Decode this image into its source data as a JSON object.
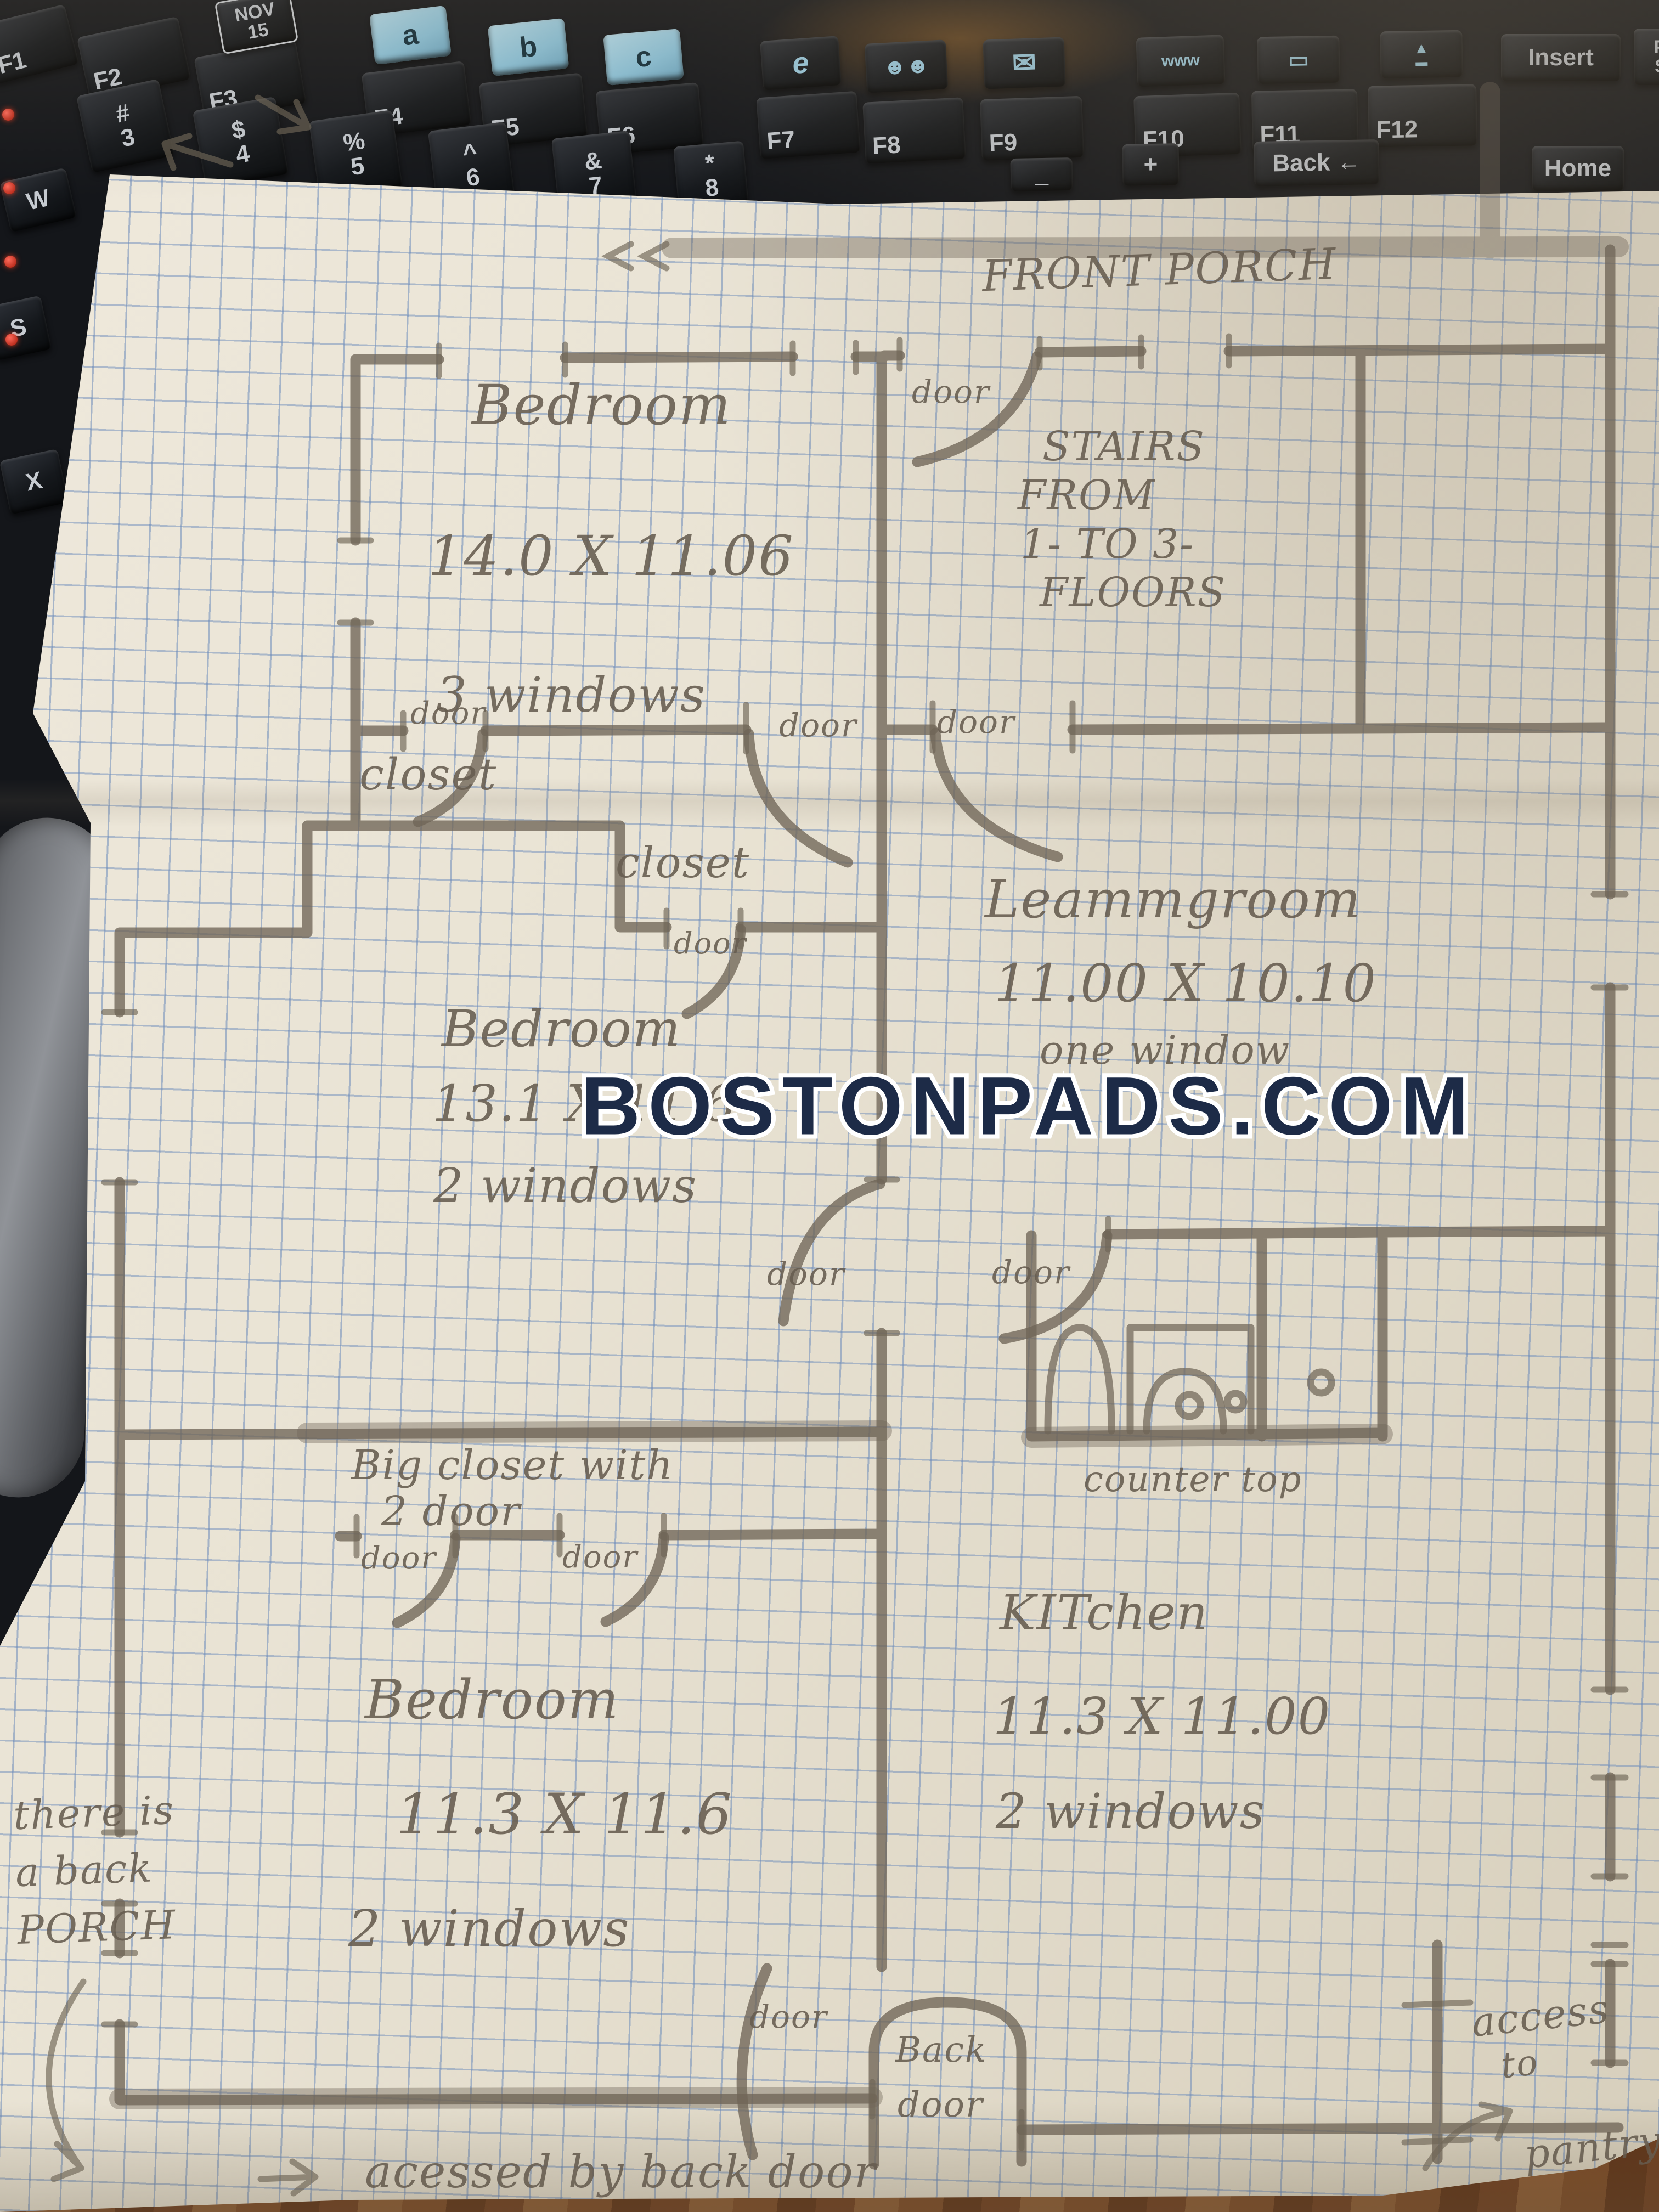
{
  "watermark": {
    "text": "BOSTONPADS.COM",
    "color": "#1d2b47"
  },
  "plan": {
    "door_label": "door",
    "front_porch": "FRONT PORCH",
    "stairs": {
      "l1": "STAIRS",
      "l2": "FROM",
      "l3": "1- TO 3-",
      "l4": "FLOORS"
    },
    "bedroom_top": {
      "name": "Bedroom",
      "dims": "14.0 X 11.06",
      "windows": "3 windows"
    },
    "closet_top": "closet",
    "closet_mid": "closet",
    "living": {
      "name": "Leammgroom",
      "dims": "11.00 X 10.10",
      "windows": "one window"
    },
    "bedroom_mid": {
      "name": "Bedroom",
      "dims": "13.1 X 11.6",
      "windows": "2 windows"
    },
    "bathroom": {
      "counter": "counter top"
    },
    "kitchen": {
      "name": "KITchen",
      "dims": "11.3 X 11.00",
      "windows": "2 windows"
    },
    "big_closet": {
      "l1": "Big closet with",
      "l2": "2 door"
    },
    "bedroom_bottom": {
      "name": "Bedroom",
      "dims": "11.3 X 11.6",
      "windows": "2 windows"
    },
    "back_door": {
      "l1": "Back",
      "l2": "door"
    },
    "notes": {
      "back_porch_l1": "there is",
      "back_porch_l2": "a back",
      "back_porch_l3": "PORCH",
      "accessed": "acessed by back door",
      "pantry_l1": "access",
      "pantry_l2": "to",
      "pantry_l3": "pantry"
    }
  },
  "keyboard": {
    "fkeys": [
      "F1",
      "F2",
      "F3",
      "F4",
      "F5",
      "F6",
      "F7",
      "F8",
      "F9",
      "F10",
      "F11",
      "F12"
    ],
    "hotkeys": [
      "a",
      "b",
      "c"
    ],
    "calendar": {
      "l1": "NOV",
      "l2": "15"
    },
    "icons": {
      "ie": "e",
      "people": "☻☻",
      "mail": "✉",
      "search": "www",
      "battery": "▭",
      "eject_top": "▲",
      "eject_bar": "▬",
      "back_arrow": "←",
      "down": "▼"
    },
    "numrow": [
      {
        "t": "#",
        "b": "3"
      },
      {
        "t": "$",
        "b": "4"
      },
      {
        "t": "%",
        "b": "5"
      },
      {
        "t": "^",
        "b": "6"
      },
      {
        "t": "&",
        "b": "7"
      },
      {
        "t": "*",
        "b": "8"
      }
    ],
    "letters": [
      "W",
      "S",
      "X"
    ],
    "insert": "Insert",
    "home": "Home",
    "back": "Back",
    "prtsc_l1": "Pri",
    "prtsc_l2": "Sc",
    "delete_fragment": "ete",
    "plus": "+",
    "underscore": "_"
  }
}
